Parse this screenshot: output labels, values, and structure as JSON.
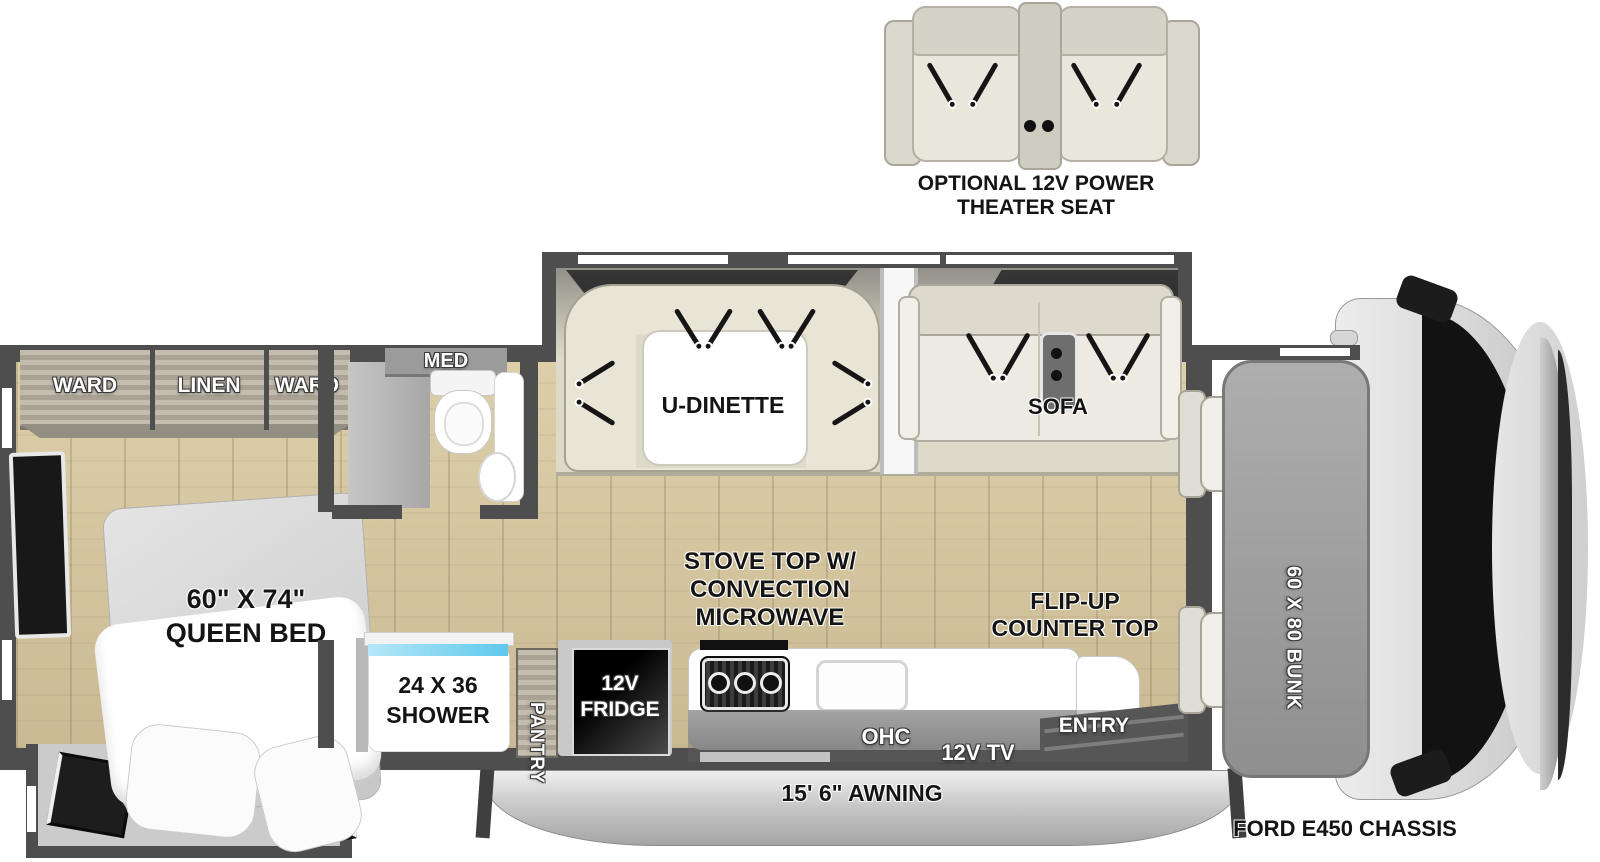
{
  "theater": {
    "caption1": "OPTIONAL 12V POWER",
    "caption2": "THEATER SEAT"
  },
  "bedroom": {
    "ward_left": "WARD",
    "linen": "LINEN",
    "ward_right": "WARD",
    "bed1": "60\" X 74\"",
    "bed2": "QUEEN BED"
  },
  "bathroom": {
    "med": "MED"
  },
  "shower": {
    "l1": "24 X 36",
    "l2": "SHOWER"
  },
  "storage": {
    "pantry": "PANTRY",
    "fridge1": "12V",
    "fridge2": "FRIDGE"
  },
  "kitchen": {
    "stove1": "STOVE TOP W/",
    "stove2": "CONVECTION",
    "stove3": "MICROWAVE",
    "flip1": "FLIP-UP",
    "flip2": "COUNTER TOP",
    "ohc": "OHC",
    "tv": "12V TV",
    "entry": "ENTRY"
  },
  "living": {
    "ohc_dinette": "OHC",
    "dinette": "U-DINETTE",
    "ohc_sofa": "OHC",
    "sofa": "SOFA"
  },
  "cab": {
    "bunk": "60 X 80 BUNK",
    "chassis": "FORD E450 CHASSIS"
  },
  "exterior": {
    "awning": "15' 6\" AWNING"
  },
  "colors": {
    "wall": "#4e4e4e",
    "floor_wood": "#d3c49e",
    "slide_floor": "#dedac9",
    "cushion": "#edeae1",
    "shower_glass": "#6fcdee",
    "fridge": "#111111",
    "label_black": "#141414",
    "label_white": "#ffffff"
  }
}
